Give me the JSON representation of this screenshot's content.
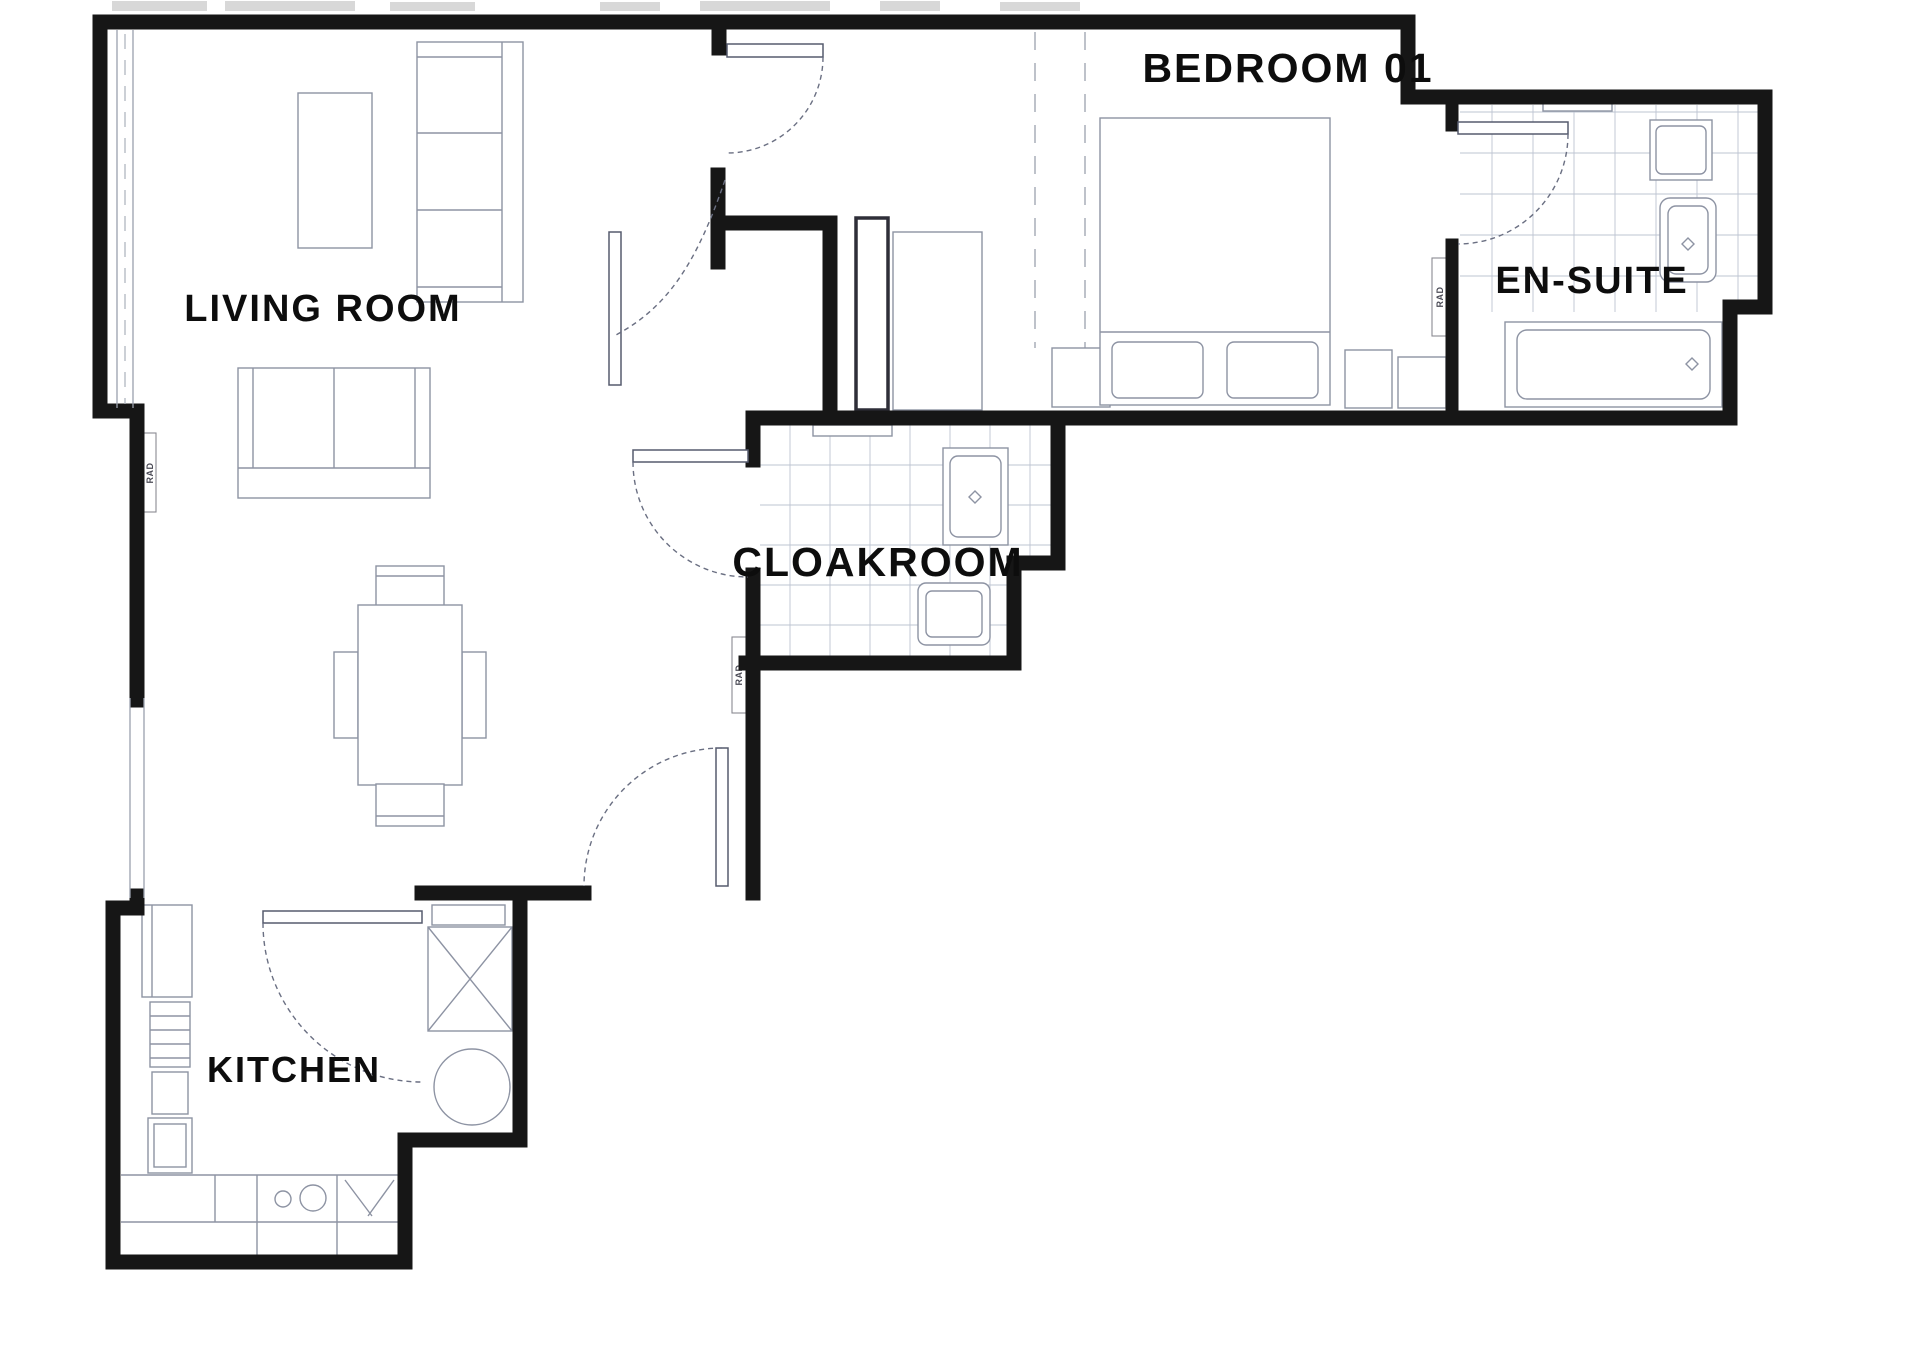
{
  "plan": {
    "type": "floor-plan",
    "rooms": {
      "living": {
        "label": "LIVING ROOM"
      },
      "kitchen": {
        "label": "KITCHEN"
      },
      "cloakroom": {
        "label": "CLOAKROOM"
      },
      "bedroom": {
        "label": "BEDROOM 01"
      },
      "ensuite": {
        "label": "EN-SUITE"
      }
    },
    "radiator_label": "RAD",
    "colors": {
      "wall": "#161616",
      "furniture_line": "#8d93a3",
      "tile_line": "#bdc4d1",
      "door_line": "#565b6e",
      "background": "#ffffff",
      "label_text": "#0d0d0d"
    }
  }
}
